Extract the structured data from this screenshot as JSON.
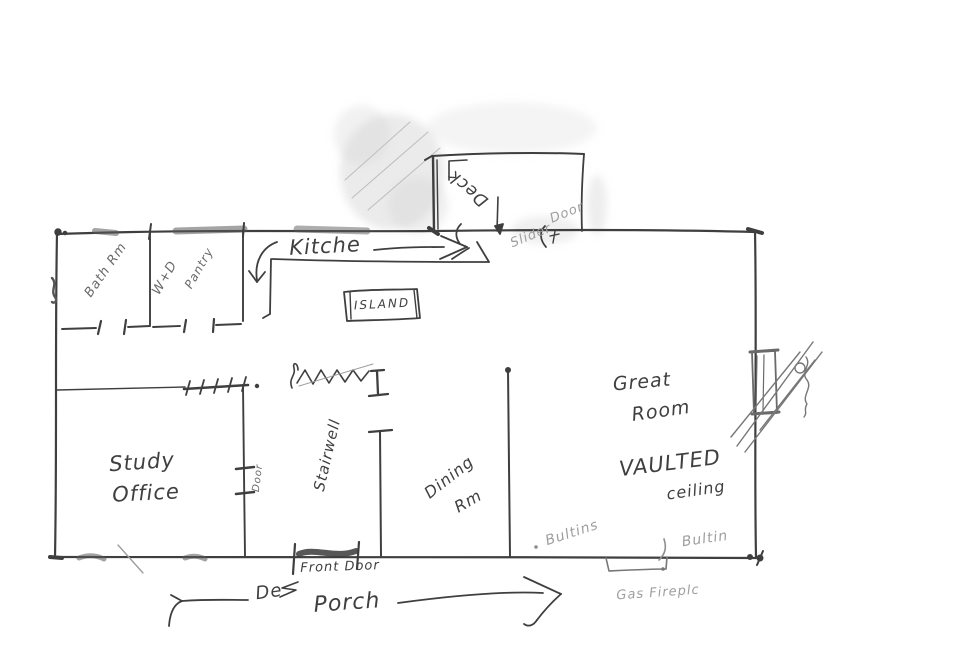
{
  "document_title": "Hand-drawn house floor plan sketch",
  "labels": {
    "kitchen": "Kitche",
    "island": "ISLAND",
    "bath": "Bath Rm",
    "washer_dryer": "W+D",
    "pantry": "Pantry",
    "deck": "Deck",
    "slider_word1": "Slider",
    "slider_word2": "Door",
    "great1": "Great",
    "great2": "Room",
    "vaulted1": "VAULTED",
    "vaulted2": "ceiling",
    "study1": "Study",
    "study2": "Office",
    "study_door": "Door",
    "stairwell": "Stairwell",
    "dining1": "Dining",
    "dining2": "Rm",
    "front_door": "Front Door",
    "de_scribble": "De",
    "porch": "Porch",
    "builtins_left": "Bultins",
    "builtins_right": "Bultin",
    "gas_fireplace": "Gas Fireplc"
  },
  "colors": {
    "pencil_dark": "#3f3f3f",
    "pencil_mid": "#6a6a6a",
    "pencil_light": "#9e9e9e",
    "pencil_faint": "#c4c4c4",
    "paper": "#ffffff"
  }
}
